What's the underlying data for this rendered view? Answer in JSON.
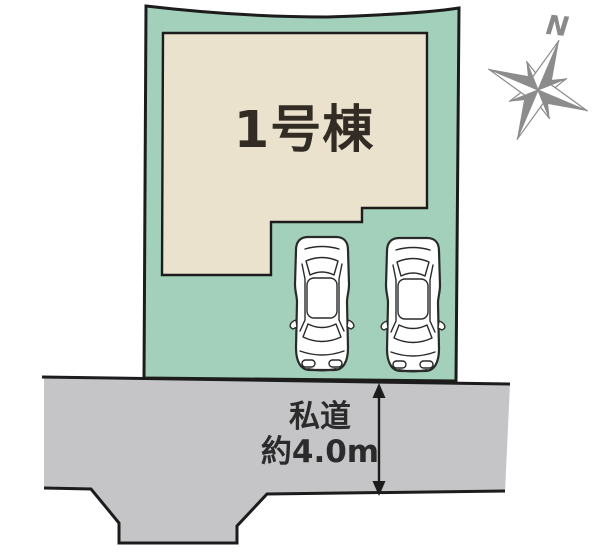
{
  "labels": {
    "building": "1号棟",
    "road_line1": "私道",
    "road_line2": "約4.0m",
    "compass_north": "N"
  },
  "road": {
    "name": "私道",
    "width_value": "約4.0m"
  },
  "cars": {
    "count": 2
  },
  "icons": {
    "compass": "compass-rose-icon (8-point star)",
    "car": "car-top-view-icon",
    "dimension_arrow": "double-headed-vertical-arrow"
  },
  "colors": {
    "lot_fill": "#a3d0ba",
    "building_fill": "#eae2cd",
    "road_fill": "#c5c5c7",
    "outline": "#1c1c1c",
    "car_fill": "#ffffff",
    "compass_gray": "#8c8c8c",
    "label_text": "#2b2b2b"
  }
}
